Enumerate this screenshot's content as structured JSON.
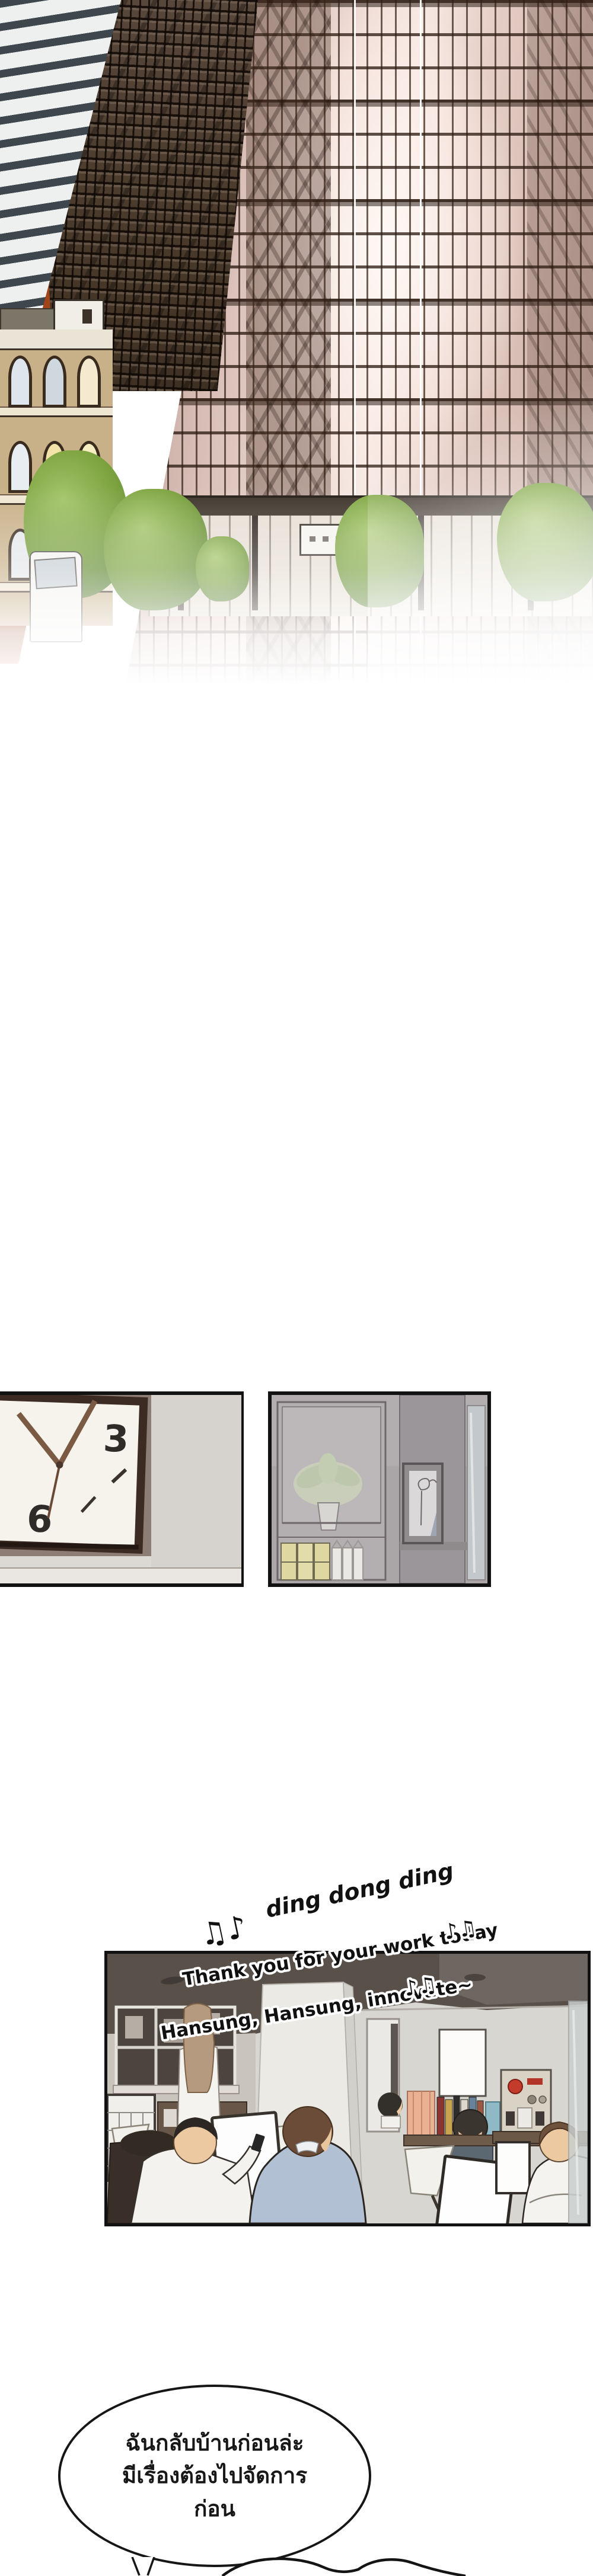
{
  "clock_panel": {
    "numbers": {
      "three": "3",
      "six": "6"
    }
  },
  "office_panel": {
    "sfx": {
      "notes": "♫♪",
      "text": "ding dong ding"
    },
    "song": {
      "line1": {
        "text": "Thank you for your work today",
        "notes": "♪♫"
      },
      "line2": {
        "text": "Hansung, Hansung, innovate~",
        "notes": "♪♫"
      }
    }
  },
  "speech_bubble": {
    "lines": [
      "ฉันกลับบ้านก่อนล่ะ",
      "มีเรื่องต้องไปจัดการ",
      "ก่อน"
    ]
  },
  "colors": {
    "sky_orange": "#b5531f",
    "panel_border": "#121212",
    "bubble_outline": "#161616",
    "song_text": "#111111",
    "song_outline": "#ffffff",
    "glass_pink": "#efdcd5",
    "tree_green": "#7ba23f"
  }
}
